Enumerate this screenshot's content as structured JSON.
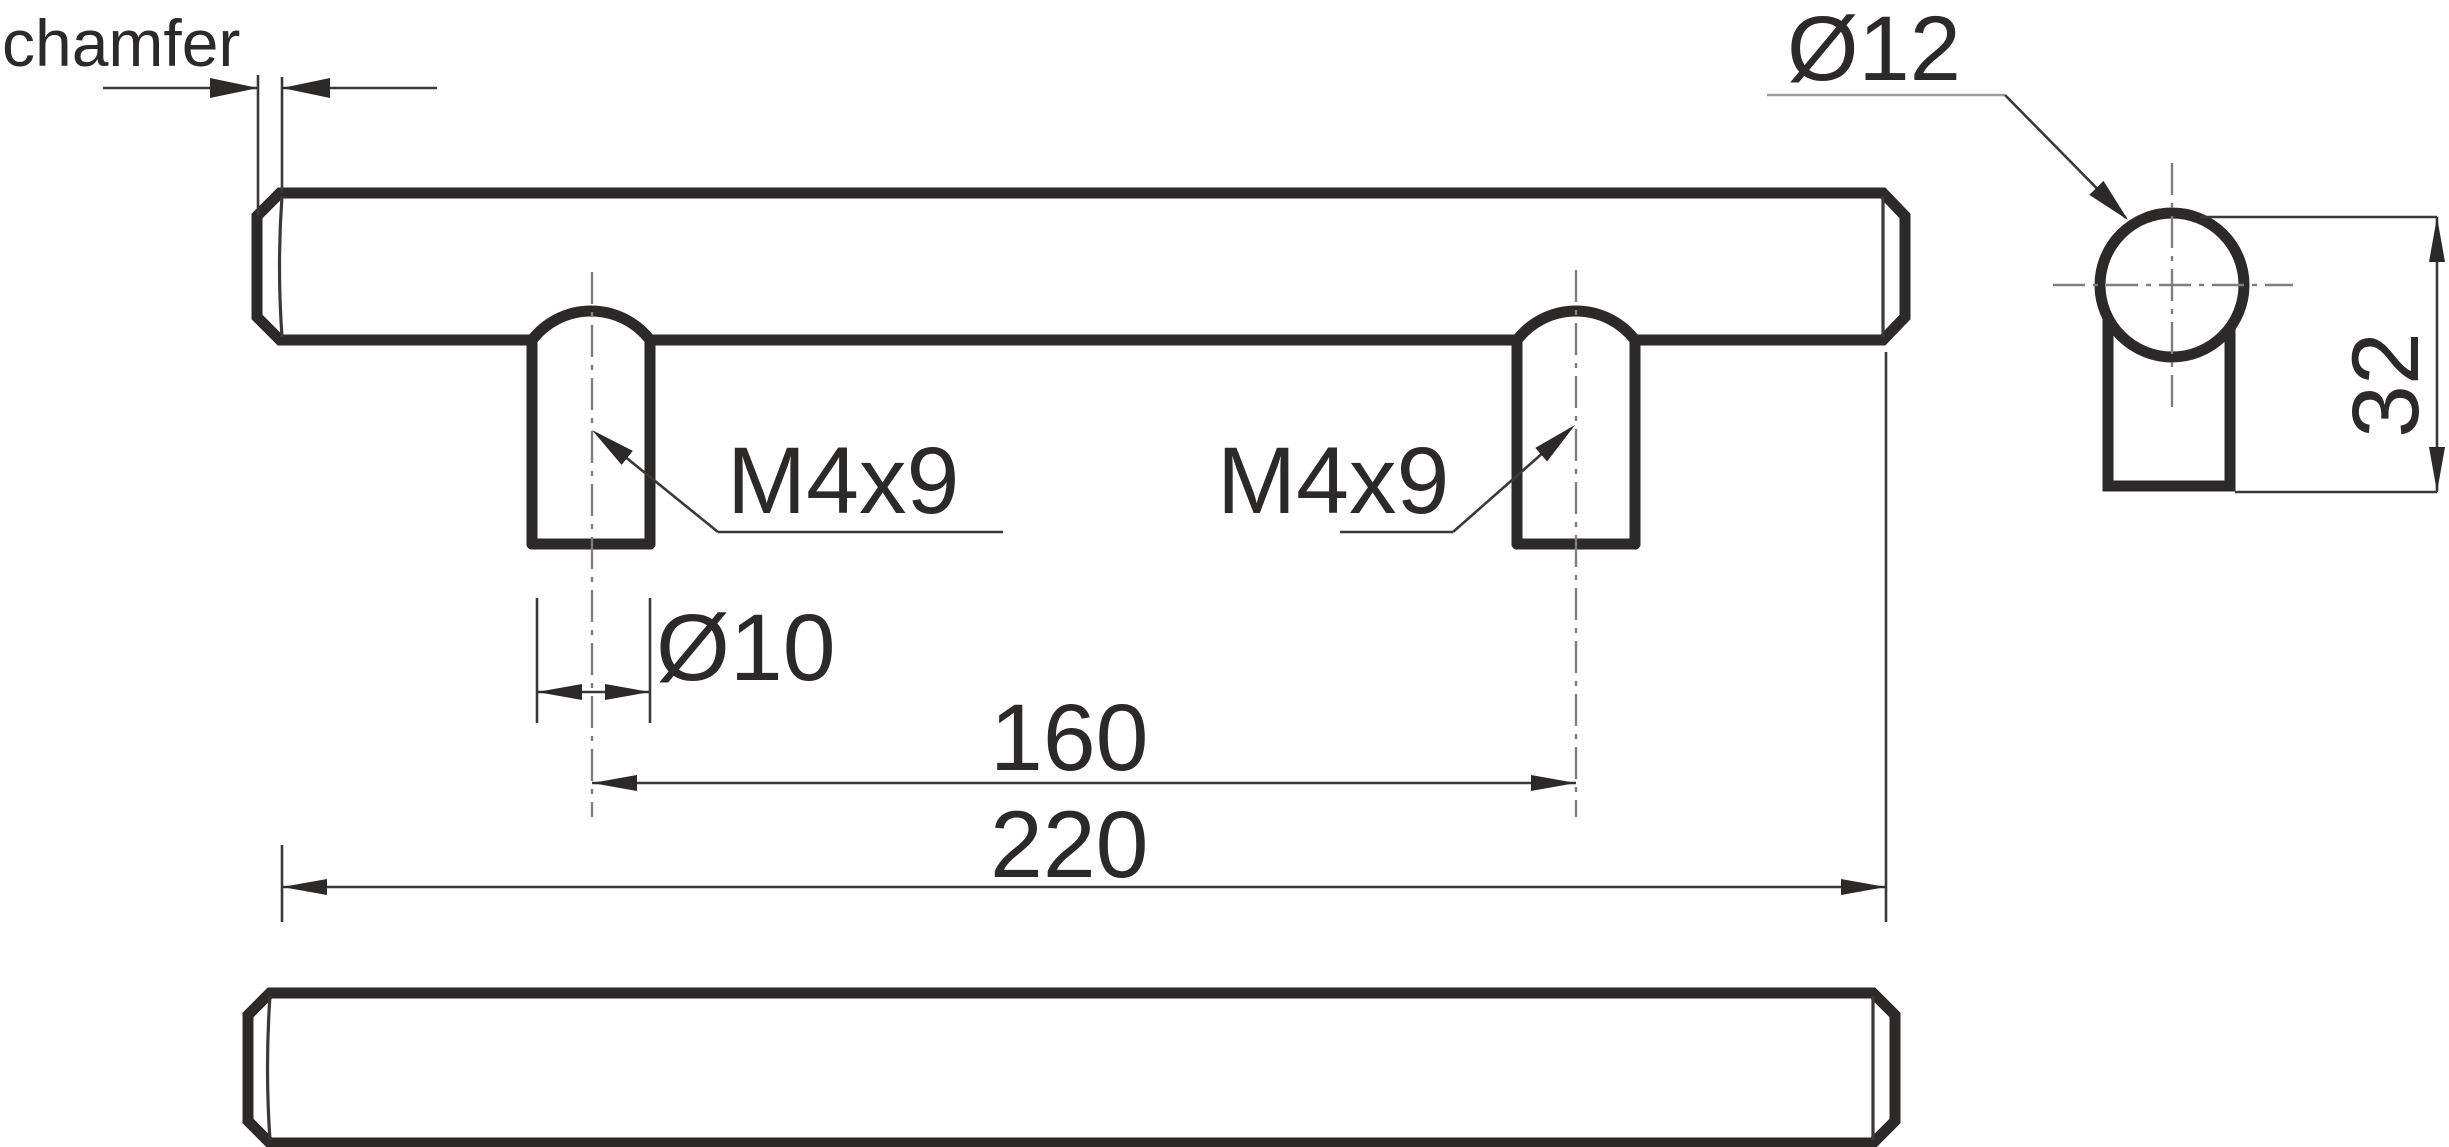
{
  "drawing": {
    "type": "technical-dimension-drawing",
    "subject": "bar-pull-handle",
    "labels": {
      "chamfer": "chamfer",
      "dia12": "Ø12",
      "m4x9_left": "M4x9",
      "m4x9_right": "M4x9",
      "dia10": "Ø10",
      "dim160": "160",
      "dim220": "220",
      "dim32": "32"
    },
    "dimensions": [
      {
        "name": "chamfer-width",
        "label": "chamfer"
      },
      {
        "name": "bar-diameter",
        "label": "Ø12"
      },
      {
        "name": "thread-left",
        "label": "M4x9"
      },
      {
        "name": "thread-right",
        "label": "M4x9"
      },
      {
        "name": "post-diameter",
        "label": "Ø10"
      },
      {
        "name": "hole-spacing",
        "label": "160"
      },
      {
        "name": "overall-length",
        "label": "220"
      },
      {
        "name": "overall-height",
        "label": "32"
      }
    ],
    "colors": {
      "background": "#ffffff",
      "outline": "#2b2a29",
      "thin_line": "#3a3938",
      "centerline": "#7e7e7c",
      "text": "#2b2a29"
    }
  }
}
